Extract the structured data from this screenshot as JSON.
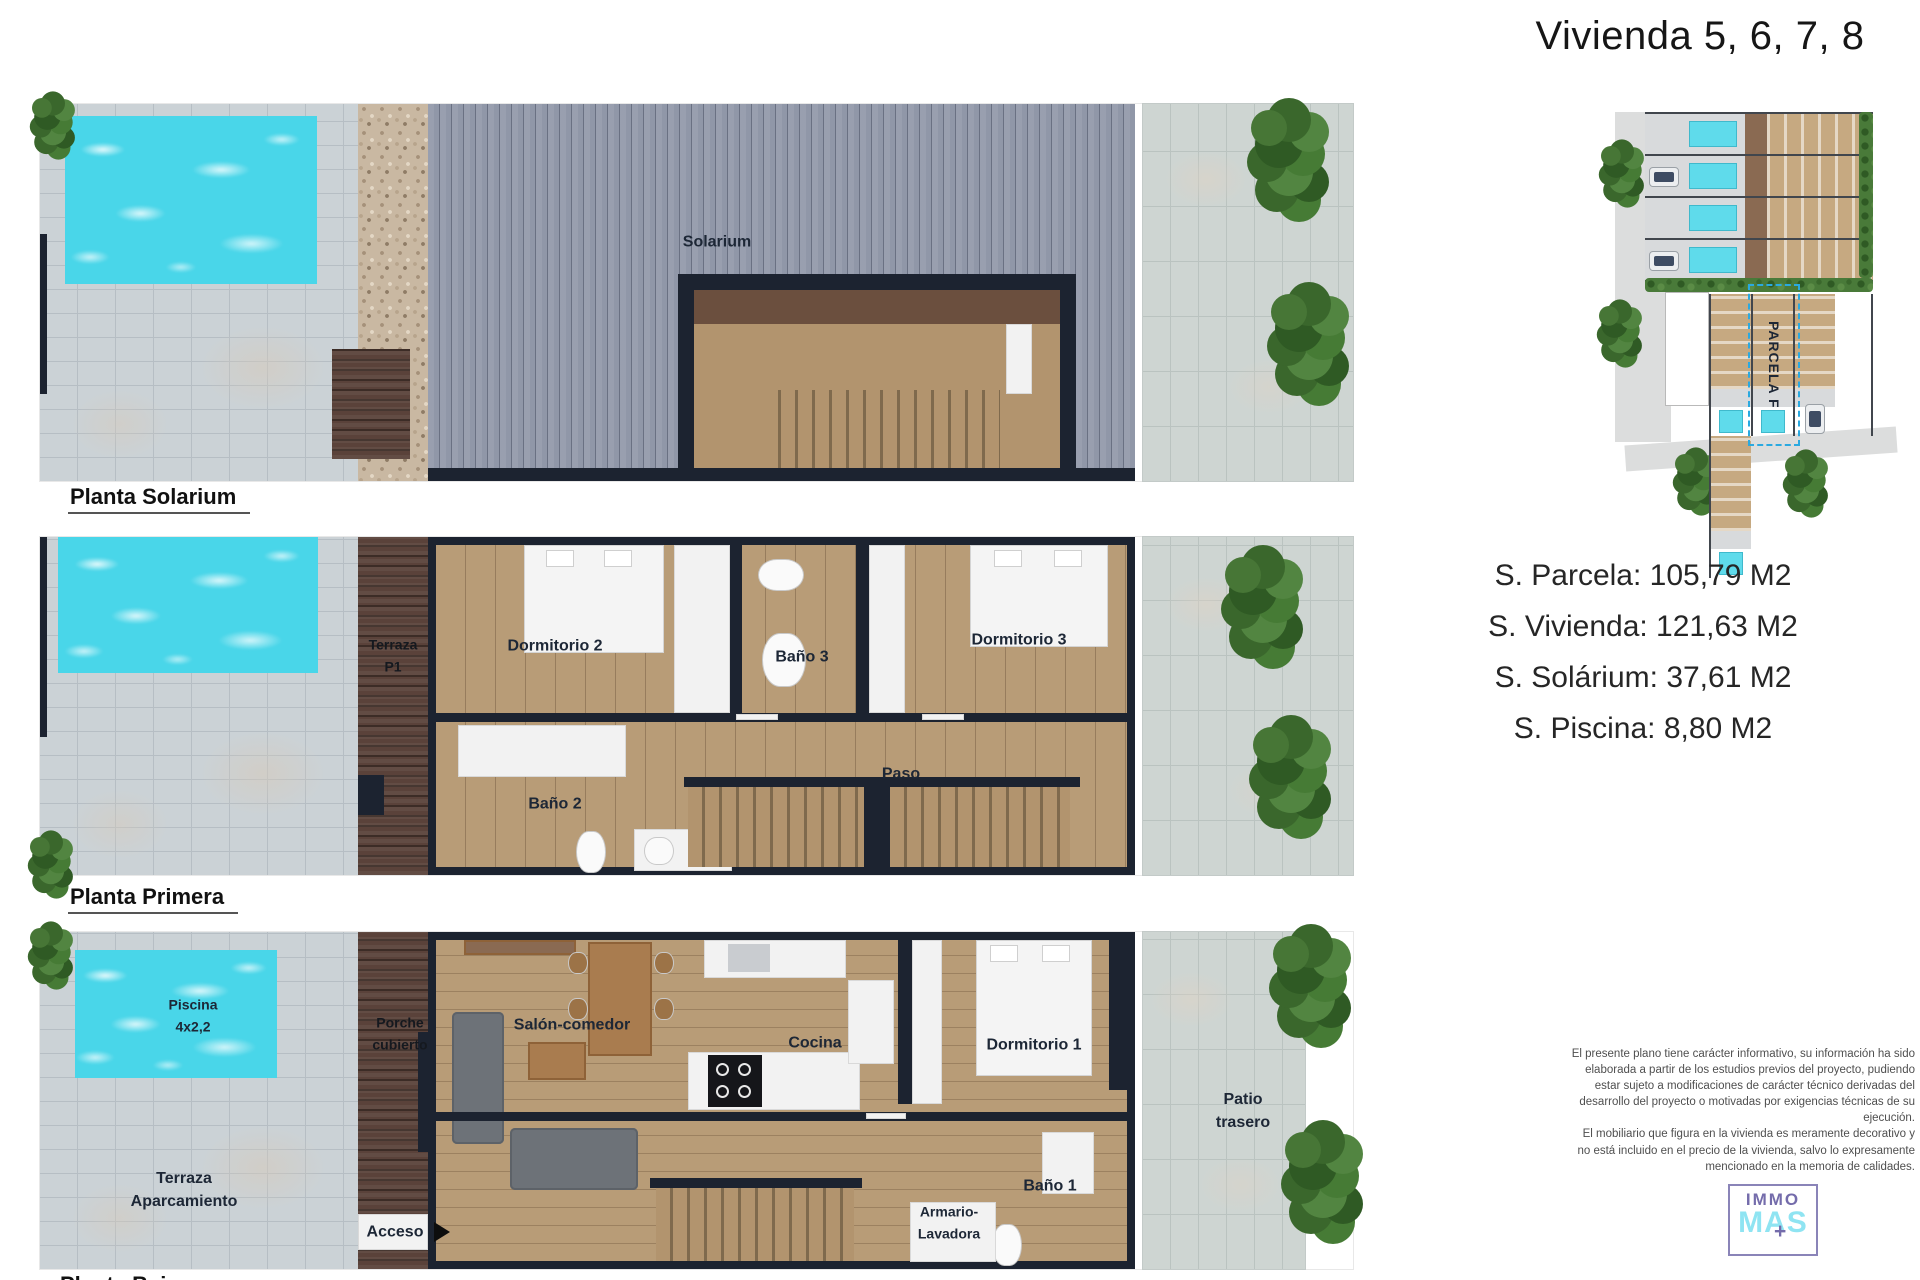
{
  "title": "Vivienda 5, 6, 7, 8",
  "plans": [
    {
      "label": "Planta Solarium",
      "rooms": {
        "solarium": "Solarium"
      }
    },
    {
      "label": "Planta Primera",
      "rooms": {
        "terraza": "Terraza\nP1",
        "dormitorio2": "Dormitorio 2",
        "bano3": "Baño 3",
        "dormitorio3": "Dormitorio 3",
        "bano2": "Baño 2",
        "paso": "Paso"
      }
    },
    {
      "label": "Planta Baja",
      "rooms": {
        "piscina": "Piscina\n4x2,2",
        "porche": "Porche\ncubierto",
        "salon": "Salón-comedor",
        "cocina": "Cocina",
        "dormitorio1": "Dormitorio 1",
        "terraza_aparcamiento": "Terraza\nAparcamiento",
        "acceso": "Acceso",
        "armario": "Armario-\nLavadora",
        "bano1": "Baño 1",
        "patio": "Patio\ntrasero"
      }
    }
  ],
  "site_plan": {
    "parcel_label": "PARCELA F"
  },
  "measurements": [
    "S. Parcela: 105,79 M2",
    "S. Vivienda: 121,63 M2",
    "S. Solárium: 37,61 M2",
    "S. Piscina: 8,80 M2"
  ],
  "disclaimer": {
    "p1": "El presente plano tiene carácter informativo, su información ha sido elaborada a partir de los estudios previos del proyecto, pudiendo estar sujeto a modificaciones de carácter técnico derivadas del desarrollo del proyecto o motivadas por exigencias técnicas de su ejecución.",
    "p2": "El mobiliario que figura en la vivienda es meramente decorativo y no está incluido en el precio de la vivienda, salvo lo expresamente mencionado en la memoria de calidades."
  },
  "logo": {
    "line1": "IMMO",
    "line2": "MAS",
    "plus": "+"
  },
  "colors": {
    "pool": "#49d6e9",
    "wall": "#1c2330",
    "floor": "#b89c77",
    "parcel_dashed": "#2aa9e0",
    "logo_purple": "#746cab",
    "logo_cyan": "#8fe4f2"
  }
}
